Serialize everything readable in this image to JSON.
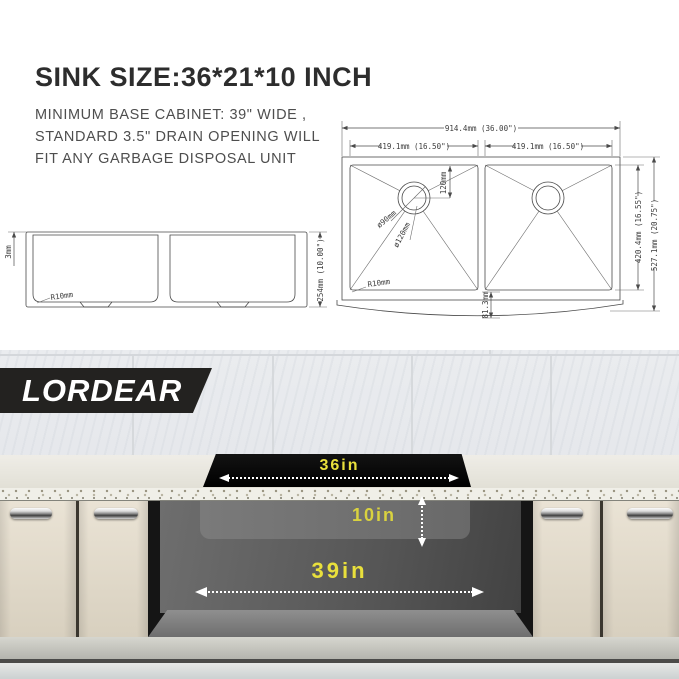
{
  "header": {
    "title": "SINK SIZE:36*21*10 INCH",
    "line1": "MINIMUM BASE CABINET: 39\" WIDE ,",
    "line2": "STANDARD 3.5\" DRAIN OPENING WILL",
    "line3": "FIT ANY GARBAGE DISPOSAL UNIT"
  },
  "brand": {
    "name": "LORDEAR"
  },
  "diagram": {
    "top_view": {
      "overall_width": "914.4mm (36.00\")",
      "left_bowl_width": "419.1mm (16.50\")",
      "right_bowl_width": "419.1mm (16.50\")",
      "bowl_front_to_back": "420.4mm (16.55\")",
      "overall_front_to_back": "527.1mm (20.75\")",
      "drain_offset": "120mm",
      "drain_inner_diameter": "ø90mm",
      "drain_outer_diameter": "ø120mm",
      "corner_radius": "R10mm",
      "apron_overhang": "81.3mm"
    },
    "side_view": {
      "rim_thickness": "3mm",
      "corner_radius": "R10mm",
      "bowl_height": "254mm (10.00\")"
    }
  },
  "scene": {
    "sink_width_label": "36in",
    "sink_depth_label": "10in",
    "cabinet_width_label": "39in"
  },
  "colors": {
    "accent_yellow": "#e9e03c",
    "banner_black": "#232220",
    "door_cream": "#e0d8c8"
  }
}
